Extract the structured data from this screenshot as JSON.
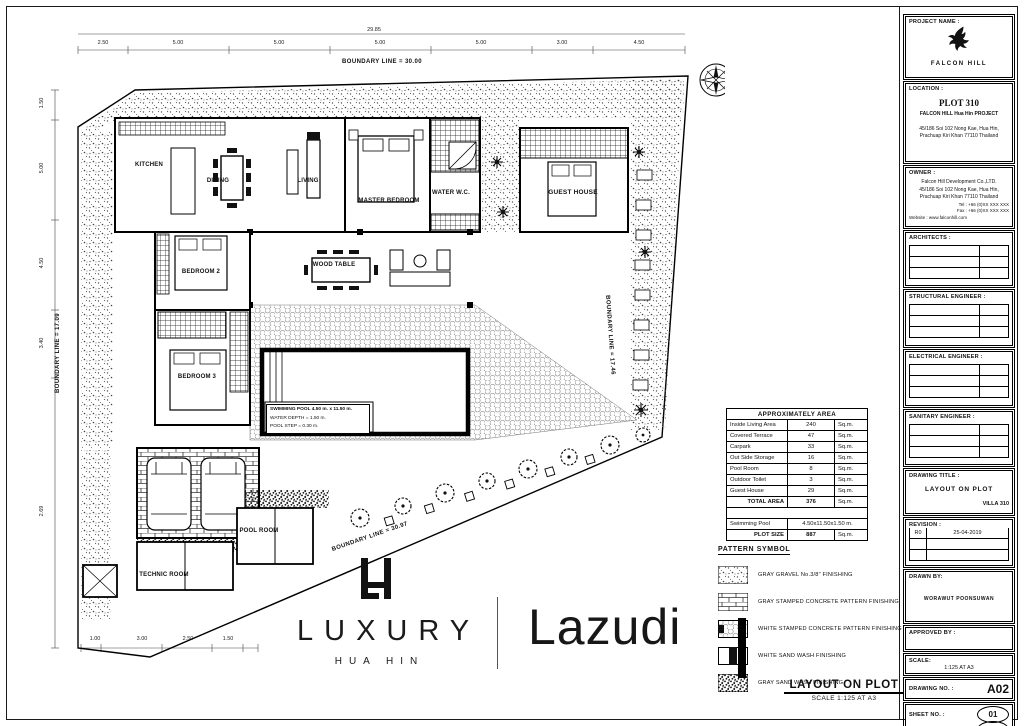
{
  "plan": {
    "rooms": [
      {
        "label": "KITCHEN"
      },
      {
        "label": "DINING"
      },
      {
        "label": "LIVING"
      },
      {
        "label": "MASTER BEDROOM"
      },
      {
        "label": "WATER W.C."
      },
      {
        "label": "GUEST HOUSE"
      },
      {
        "label": "BEDROOM 2"
      },
      {
        "label": "WOOD TABLE"
      },
      {
        "label": "BEDROOM 3"
      },
      {
        "label": "TECHNIC ROOM"
      },
      {
        "label": "POOL ROOM"
      }
    ],
    "pool_info": [
      "SWIMMING POOL 4.50 m. x 11.50 m.",
      "WATER DEPTH = 1.50 m.",
      "POOL STEP = 0.30 m."
    ],
    "boundaries": {
      "top": "BOUNDARY LINE = 30.00",
      "right": "BOUNDARY LINE = 17.46",
      "diagonal": "BOUNDARY LINE = 30.97",
      "left": "BOUNDARY LINE = 17.09"
    },
    "dims": {
      "overall_top": "29.85",
      "top": [
        "2.50",
        "5.00",
        "5.00",
        "5.00",
        "5.00",
        "3.00",
        "4.50"
      ],
      "left": [
        "1.50",
        "5.00",
        "4.50",
        "3.40",
        "2.69"
      ],
      "bottom": [
        "1.00",
        "3.00",
        "2.50",
        "1.50"
      ]
    }
  },
  "area_table": {
    "title": "APPROXIMATELY AREA",
    "rows": [
      {
        "name": "Inside Living Area",
        "value": "240",
        "unit": "Sq.m."
      },
      {
        "name": "Covered Terrace",
        "value": "47",
        "unit": "Sq.m."
      },
      {
        "name": "Carpark",
        "value": "33",
        "unit": "Sq.m."
      },
      {
        "name": "Out Side Storage",
        "value": "16",
        "unit": "Sq.m."
      },
      {
        "name": "Pool Room",
        "value": "8",
        "unit": "Sq.m."
      },
      {
        "name": "Outdoor Toilet",
        "value": "3",
        "unit": "Sq.m."
      },
      {
        "name": "Guest House",
        "value": "29",
        "unit": "Sq.m."
      }
    ],
    "total": {
      "name": "TOTAL AREA",
      "value": "376",
      "unit": "Sq.m."
    },
    "pool": {
      "name": "Swimming Pool",
      "value": "4.50x11.50x1.50 m."
    },
    "plot": {
      "name": "PLOT SIZE",
      "value": "887",
      "unit": "Sq.m."
    }
  },
  "legend": {
    "title": "PATTERN SYMBOL",
    "items": [
      {
        "pattern": "gravel",
        "label": "GRAY GRAVEL No.3/8\" FINISHING"
      },
      {
        "pattern": "gray-stamped-concrete",
        "label": "GRAY STAMPED CONCRETE PATTERN FINISHING"
      },
      {
        "pattern": "white-stamped-concrete",
        "label": "WHITE STAMPED CONCRETE PATTERN FINISHING"
      },
      {
        "pattern": "white-sand-wash",
        "label": "WHITE SAND WASH FINISHING"
      },
      {
        "pattern": "gray-sand-wash",
        "label": "GRAY SAND WASH FINISHING"
      }
    ]
  },
  "footer": {
    "layout_title": "LAYOUT ON PLOT",
    "scale_note": "SCALE 1:125 AT A3"
  },
  "logos": {
    "luxury": {
      "monogram": "LH",
      "name": "LUXURY",
      "sub": "HUA HIN"
    },
    "lazudi": "Lazudi"
  },
  "title_block": {
    "project": {
      "label": "PROJECT NAME :",
      "name": "FALCON HILL"
    },
    "location": {
      "label": "LOCATION :",
      "plot": "PLOT 310",
      "lines": [
        "FALCON HILL Hua Hin PROJECT",
        "45/186 Soi 102 Nong Kae, Hua Hin,",
        "Prachuap Kiri Khan 77110 Thailand"
      ]
    },
    "owner": {
      "label": "OWNER :",
      "lines": [
        "Falcon Hill Development Co.,LTD.",
        "45/186 Soi 102 Nong Kae, Hua Hin,",
        "Prachuap Kiri Khan 77110 Thailand",
        "Tel : +66 (0)XX XXX XXX",
        "Fax : +66 (0)XX XXX XXX",
        "Website : www.falconhill.com"
      ]
    },
    "architects_label": "ARCHITECTS :",
    "structural_label": "STRUCTURAL ENGINEER :",
    "electrical_label": "ELECTRICAL ENGINEER :",
    "sanitary_label": "SANITARY ENGINEER :",
    "drawing_title": {
      "label": "DRAWING TITLE :",
      "title": "LAYOUT ON PLOT",
      "villa": "VILLA 310"
    },
    "revision": {
      "label": "REVISION :",
      "rows": [
        {
          "rev": "R0",
          "date": "25-04-2019"
        },
        {
          "rev": "",
          "date": ""
        },
        {
          "rev": "",
          "date": ""
        }
      ]
    },
    "drawn_by": {
      "label": "DRAWN BY:",
      "name": "WORAWUT POONSUWAN"
    },
    "approved_by": {
      "label": "APPROVED BY :",
      "name": ""
    },
    "scale": {
      "label": "SCALE:",
      "value": "1:125 AT A3"
    },
    "drawing_no": {
      "label": "DRAWING NO. :",
      "value": "A02"
    },
    "sheet_no": {
      "label": "SHEET NO. :",
      "value": "01"
    },
    "total_sheets": {
      "label": "TOTAL SHEETS :",
      "value": "01"
    }
  },
  "colors": {
    "ink": "#1a1a1a",
    "hatch_gray": "#666666",
    "paper": "#ffffff"
  }
}
